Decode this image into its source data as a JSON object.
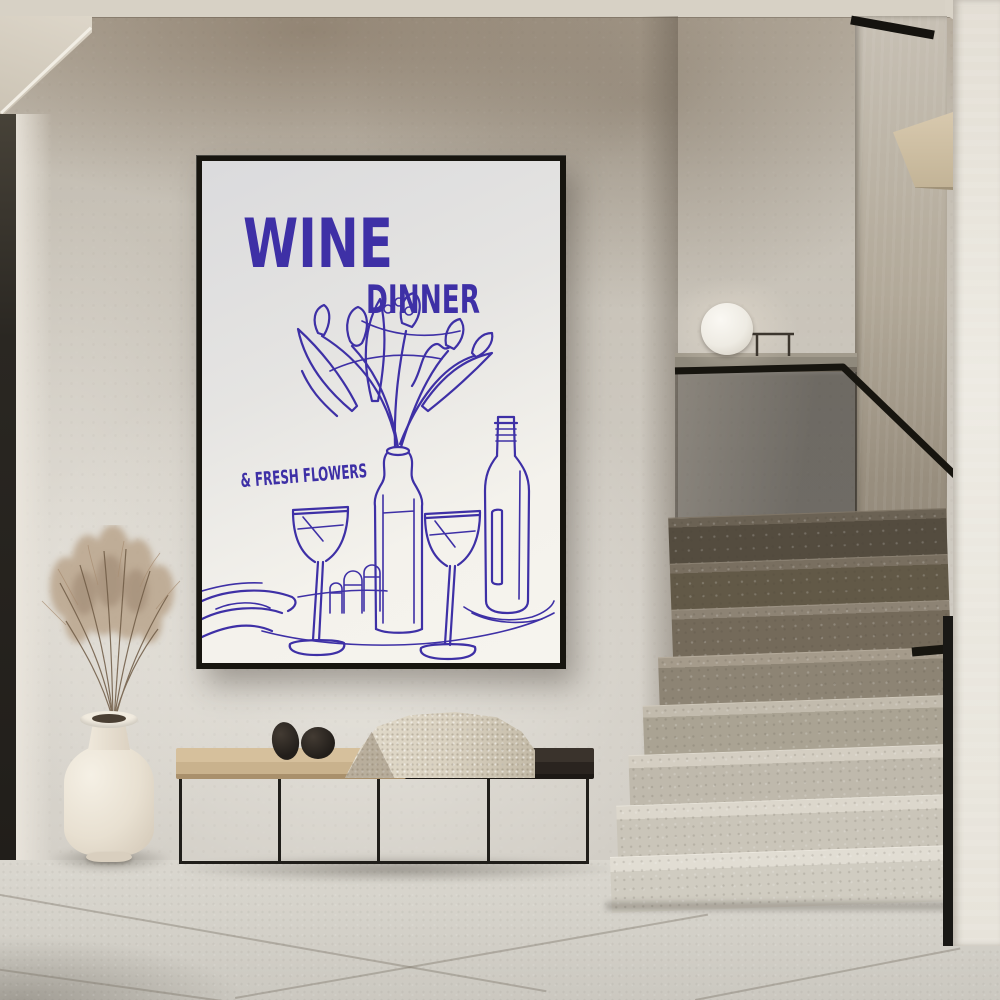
{
  "poster": {
    "title": "WINE",
    "subtitle": "DINNER",
    "tagline": "& FRESH FLOWERS",
    "ink_color": "#3e30a6",
    "paper_color": "#f2f0ea",
    "frame_color": "#17150f"
  },
  "palette": {
    "wall": "#c9c3b9",
    "ceiling": "#d7d1c5",
    "floor": "#d5d2ca",
    "door_edge": "#2a2722",
    "bench_wood": "#cdb691",
    "bench_metal": "#201e1a",
    "blanket": "#dcd4c4",
    "decor_stones": "#272320",
    "vase": "#ece4d6",
    "pampas_grass": "#b59e83",
    "stairs_upper": "#5d5546",
    "stairs_lower": "#dcd7cc",
    "handrail": "#17150f",
    "glass_balustrade": "#3a342c",
    "sphere_lamp": "#f4f1ea"
  }
}
